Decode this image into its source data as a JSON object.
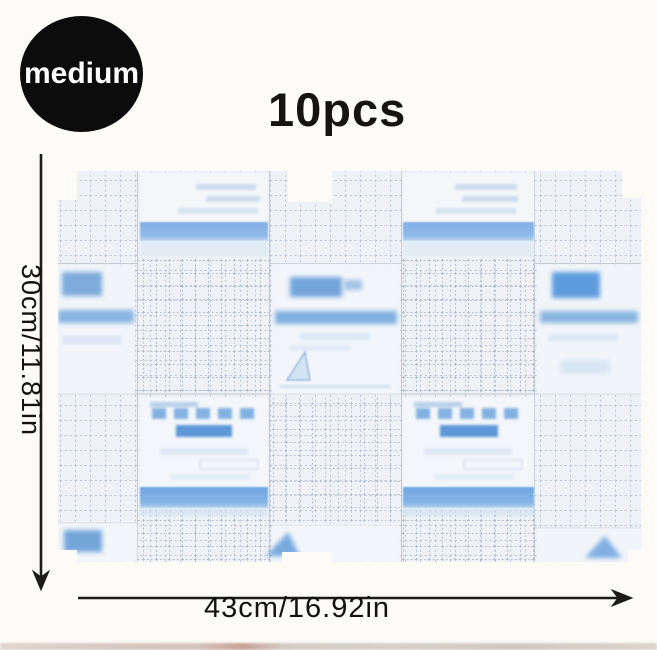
{
  "badge": {
    "label": "medium"
  },
  "quantity_label": "10pcs",
  "dimensions": {
    "height_label": "30cm/11.81in",
    "width_label": "43cm/16.92in"
  },
  "product": {
    "description": "sheet of 10 transparent film dressings (2 rows x 5 columns) with grid-printed backing, blurred blue label panels and blue bands",
    "rows": 2,
    "columns": 5,
    "colors": {
      "background": "#fcfbf7",
      "sheet_base": "#eef1f6",
      "grid_line": "#b6c1d1",
      "dense_grid_line": "#a6b2c4",
      "band_blue": "#7fafe3",
      "label_accent_blue": "#5d97d6",
      "badge_bg": "#0d0c0c",
      "annotation_ink": "#1b1a18"
    }
  }
}
